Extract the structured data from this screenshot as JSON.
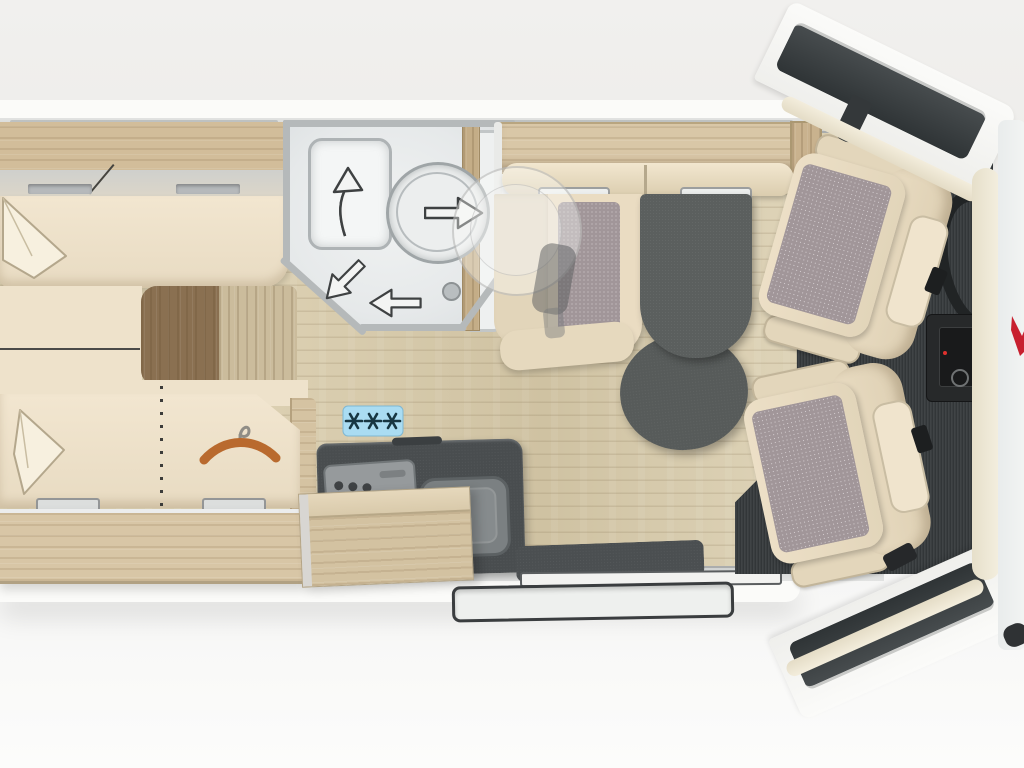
{
  "scene": {
    "label": "Motorhome floor plan, top-down view",
    "width_px": 1024,
    "height_px": 768
  },
  "palette": {
    "background": "#f0efed",
    "wood_furniture": "#d6c4a4",
    "wood_floor": "#d7cbad",
    "wood_step_dark": "#8a7051",
    "upholstery_beige": "#efe3cc",
    "seat_pattern_mauve": "#a19699",
    "dark_surface": "#4a4e50",
    "bathroom_gray": "#e9eced",
    "body_white": "#fafaf9",
    "trim_cream": "#ece5d2",
    "fridge_plate_blue": "#aadcf2",
    "hanger_orange": "#b96a2e",
    "logo_red": "#c8202f"
  },
  "areas": {
    "rear_bedroom": {
      "label": "Rear bedroom with twin single beds, overhead cabinets, entry steps and wardrobe"
    },
    "bathroom": {
      "label": "Rear bathroom with washbasin and circular shower cabin, swivel arrows"
    },
    "kitchen": {
      "label": "Kitchen block with 3-burner hob, sink, worktop flap and refrigerator symbol"
    },
    "dinette": {
      "label": "Half-dinette bench seat with two headrests and dark pedestal table"
    },
    "entry": {
      "label": "Entrance door with interior mat, sliding sill and exterior step tray"
    },
    "cab": {
      "label": "Driver cab with two swivel captain seats, steering wheel and dashboard console"
    },
    "body": {
      "label": "Vehicle cab body: door windows, mirrors, cream window frame and windscreen edge"
    }
  },
  "icons": {
    "refrigerator_symbol": "three snowflakes on light-blue plate",
    "wardrobe_symbol": "orange clothes hanger",
    "bed_extension_symbol": "vertical dotted line across lower bed",
    "shower_arrow_up": "curved arrow up from washbasin",
    "shower_arrow_right": "arrow pointing right out of shower",
    "shower_arrow_down_left": "arrow pointing diagonally down-left",
    "shower_arrow_left": "arrow pointing left",
    "floor_drain": "small circular shower drain",
    "brand_mark": "partial red logo at right image edge"
  }
}
